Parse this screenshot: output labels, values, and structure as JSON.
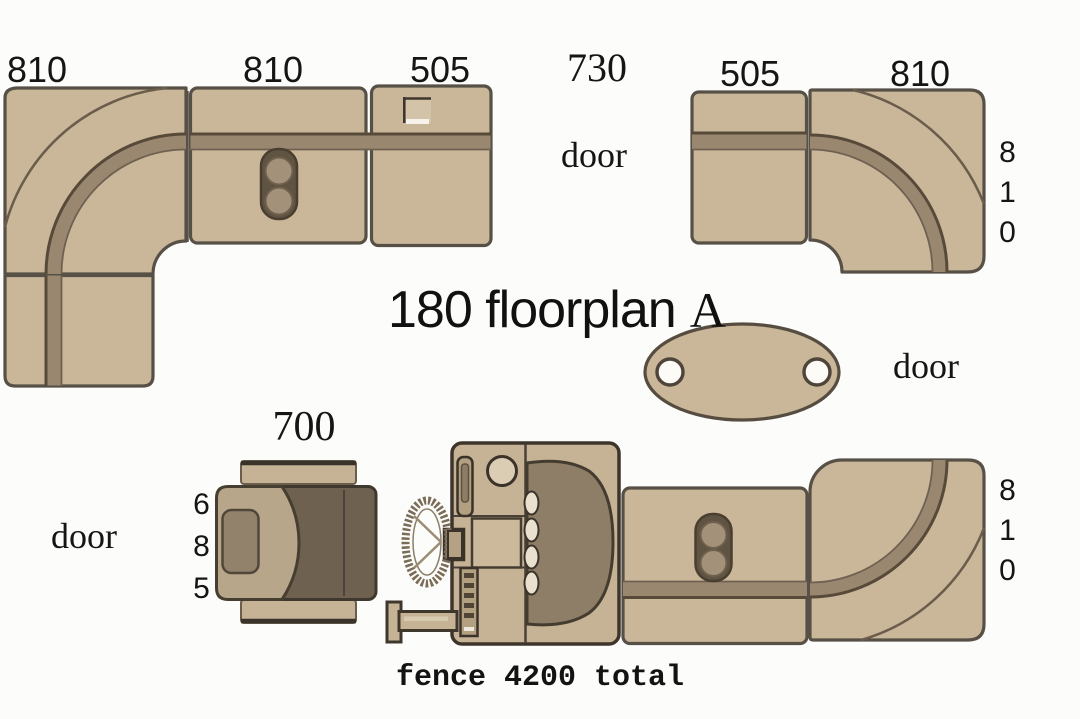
{
  "title": {
    "main": "180 floorplan",
    "suffix": "A"
  },
  "footer": {
    "text": "fence 4200 total"
  },
  "doors": {
    "top": "door",
    "right": "door",
    "left": "door"
  },
  "dimensions": {
    "left_corner_width": "810",
    "left_straight_width": "810",
    "left_short_width": "505",
    "door_gap_width": "730",
    "right_short_width": "505",
    "right_corner_width": "810",
    "right_corner_height": "810",
    "bottom_right_corner_height": "810",
    "helm_seat_width": "700",
    "helm_seat_depth": "685",
    "fence_total": "4200"
  },
  "colors": {
    "background": "#fcfcfa",
    "sofa_fill": "#cab79a",
    "sofa_outline": "#575046",
    "backrest_band": "#9a8770",
    "band_edge_dark": "#574a39",
    "seat_dark": "#6f6150",
    "backrest_tan": "#b7a689",
    "console_fill": "#c6b396",
    "windshield": "#8f7e67",
    "text": "#151515"
  }
}
